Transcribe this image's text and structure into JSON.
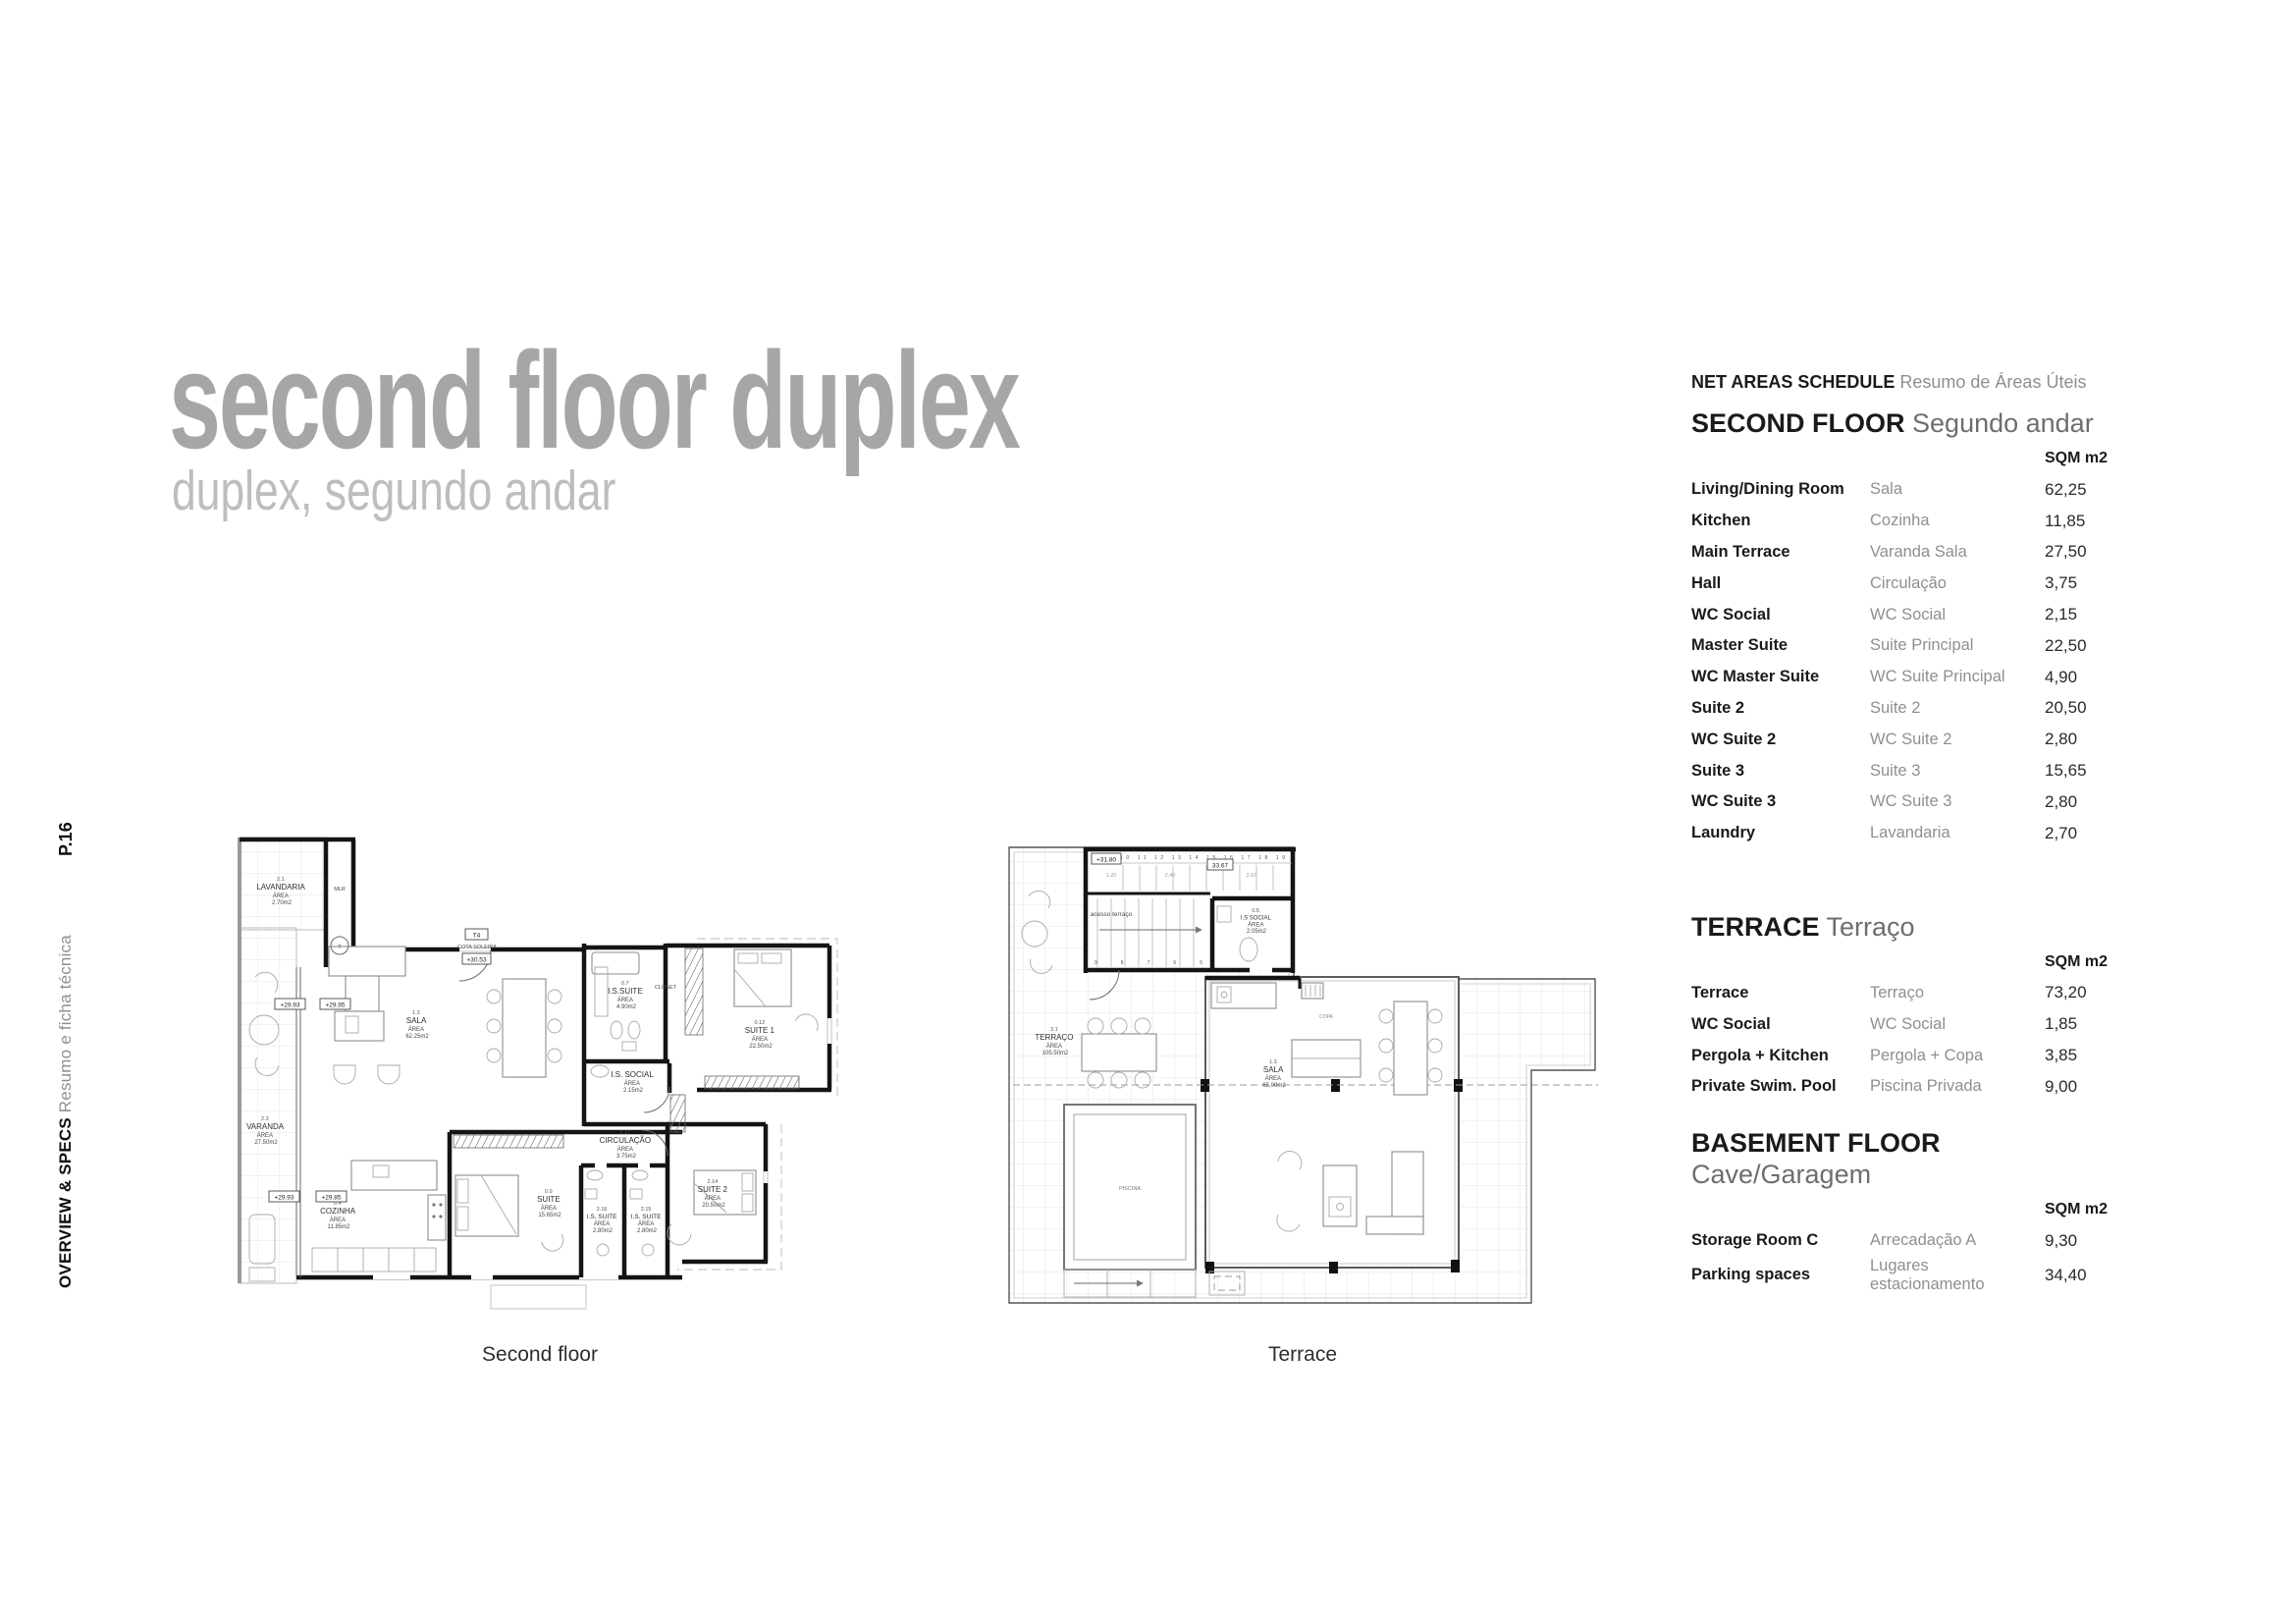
{
  "colors": {
    "title_gray": "#a6a6a6",
    "subtitle_gray": "#bdbdbd",
    "text_dark": "#1c1c1c",
    "text_gray": "#8f8f8f"
  },
  "sidebar": {
    "page": "P.16",
    "title": "OVERVIEW & SPECS",
    "subtitle": "Resumo e ficha técnica"
  },
  "header": {
    "title": "second floor duplex",
    "subtitle": "duplex, segundo andar"
  },
  "schedule": {
    "heading": "NET AREAS SCHEDULE",
    "heading_pt": "Resumo de Áreas Úteis",
    "unit": "SQM m2",
    "sections": [
      {
        "title": "SECOND FLOOR",
        "title_pt": "Segundo andar",
        "rows": [
          {
            "en": "Living/Dining Room",
            "pt": "Sala",
            "sqm": "62,25"
          },
          {
            "en": "Kitchen",
            "pt": "Cozinha",
            "sqm": "11,85"
          },
          {
            "en": "Main Terrace",
            "pt": "Varanda Sala",
            "sqm": "27,50"
          },
          {
            "en": "Hall",
            "pt": "Circulação",
            "sqm": "3,75"
          },
          {
            "en": "WC Social",
            "pt": "WC Social",
            "sqm": "2,15"
          },
          {
            "en": "Master Suite",
            "pt": "Suite Principal",
            "sqm": "22,50"
          },
          {
            "en": "WC Master Suite",
            "pt": "WC Suite Principal",
            "sqm": "4,90"
          },
          {
            "en": "Suite 2",
            "pt": "Suite 2",
            "sqm": "20,50"
          },
          {
            "en": "WC Suite 2",
            "pt": "WC Suite 2",
            "sqm": "2,80"
          },
          {
            "en": "Suite 3",
            "pt": "Suite 3",
            "sqm": "15,65"
          },
          {
            "en": "WC Suite 3",
            "pt": "WC Suite 3",
            "sqm": "2,80"
          },
          {
            "en": "Laundry",
            "pt": "Lavandaria",
            "sqm": "2,70"
          }
        ]
      },
      {
        "title": "TERRACE",
        "title_pt": "Terraço",
        "rows": [
          {
            "en": "Terrace",
            "pt": "Terraço",
            "sqm": "73,20"
          },
          {
            "en": "WC Social",
            "pt": "WC Social",
            "sqm": "1,85"
          },
          {
            "en": "Pergola + Kitchen",
            "pt": "Pergola + Copa",
            "sqm": "3,85"
          },
          {
            "en": "Private Swim. Pool",
            "pt": "Piscina Privada",
            "sqm": "9,00"
          }
        ]
      },
      {
        "title": "BASEMENT FLOOR",
        "title_pt": "Cave/Garagem",
        "rows": [
          {
            "en": "Storage Room C",
            "pt": "Arrecadação A",
            "sqm": "9,30"
          },
          {
            "en": "Parking spaces",
            "pt": "Lugares estacionamento",
            "sqm": "34,40"
          }
        ]
      }
    ]
  },
  "plans": {
    "area_word": "ÁREA",
    "second_floor": {
      "caption": "Second floor",
      "rooms": {
        "lav": {
          "code": "2.1",
          "name": "LAVANDARIA",
          "area": "2.70m2"
        },
        "var": {
          "code": "2.3",
          "name": "VARANDA",
          "area": "27.50m2"
        },
        "sala": {
          "code": "1.3",
          "name": "SALA",
          "area": "62.25m2"
        },
        "issuite": {
          "code": "0.7",
          "name": "I.S.SUITE",
          "area": "4.90m2"
        },
        "suite1": {
          "code": "0.12",
          "name": "SUITE 1",
          "area": "22.50m2"
        },
        "issocial": {
          "name": "I.S. SOCIAL",
          "area": "2.15m2"
        },
        "circ": {
          "code": "2.17",
          "name": "CIRCULAÇÃO",
          "area": "3.75m2"
        },
        "coz": {
          "code": "0.4",
          "name": "COZINHA",
          "area": "11.85m2"
        },
        "suite3": {
          "code": "0.9",
          "name": "SUITE",
          "area": "15.65m2"
        },
        "is216": {
          "code": "2.16",
          "name": "I.S. SUITE",
          "area": "2.80m2"
        },
        "is215": {
          "code": "2.15",
          "name": "I.S. SUITE",
          "area": "2.80m2"
        },
        "suite2": {
          "code": "2.14",
          "name": "SUITE 2",
          "area": "20.50m2"
        }
      },
      "texts": {
        "closet": "CLOSET",
        "mlr": "MLR",
        "t_circle": "T",
        "t4": "T4",
        "cota": "COTA SOLEIRA",
        "lvl_entry": "+30.53",
        "lvl1": "+29.93",
        "lvl2": "+29.95",
        "lvl3": "+29.93",
        "lvl4": "+29.85"
      }
    },
    "terrace": {
      "caption": "Terrace",
      "rooms": {
        "terr": {
          "code": "3.1",
          "name": "TERRAÇO",
          "area": "105.50m2"
        },
        "sala": {
          "code": "1.3",
          "name": "SALA",
          "area": "65,00m2"
        },
        "issocial": {
          "code": "0.5",
          "name": "I.S SOCIAL",
          "area": "2.05m2"
        }
      },
      "texts": {
        "acesso": "acesso terraço",
        "piscina": "PISCINA",
        "copa": "COPA",
        "lvl": "+31.80",
        "lvl2": "33.67",
        "dim1": "1.20",
        "dim2": "2.40",
        "dim3": "2.67",
        "stairs_up": "10 11 12 13 14 15 16 17 18 19",
        "stairs_dn": "9 8 7 6 5"
      }
    }
  }
}
